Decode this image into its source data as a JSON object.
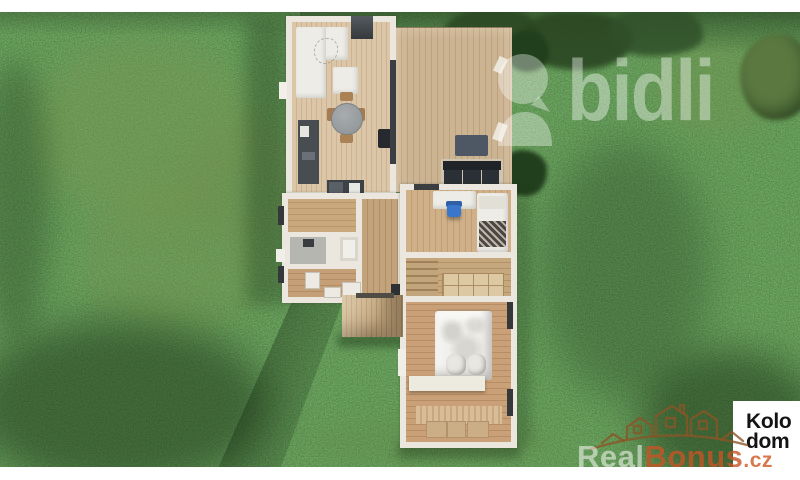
{
  "watermarks": {
    "bidli": {
      "text": "bidli",
      "color": "rgba(255,255,255,0.40)"
    },
    "realbonus": {
      "text_real": "Real",
      "text_bonus": "Bonus",
      "text_suffix": ".cz",
      "real_color": "rgba(250,250,246,0.55)",
      "accent_color": "#c65426"
    }
  },
  "corner_logo": {
    "line1": "Kolo",
    "line2": "dom",
    "text_color": "#141414",
    "bg_color": "#ffffff"
  },
  "icons": {
    "bidli_logo": "balloon-and-dome-mark",
    "realbonus_logo": "house-crown-outline"
  },
  "palette": {
    "grass_base": "#47663a",
    "grass_dark": "#2c4a24",
    "grass_light": "#7c9652",
    "wood_floor": "#d9c3a5",
    "wood_deck": "#ccb493",
    "wall_white": "#ebe7de",
    "furniture_dark": "#2b3036",
    "chair_blue": "#3a76c9",
    "letterbox": "#ffffff"
  }
}
